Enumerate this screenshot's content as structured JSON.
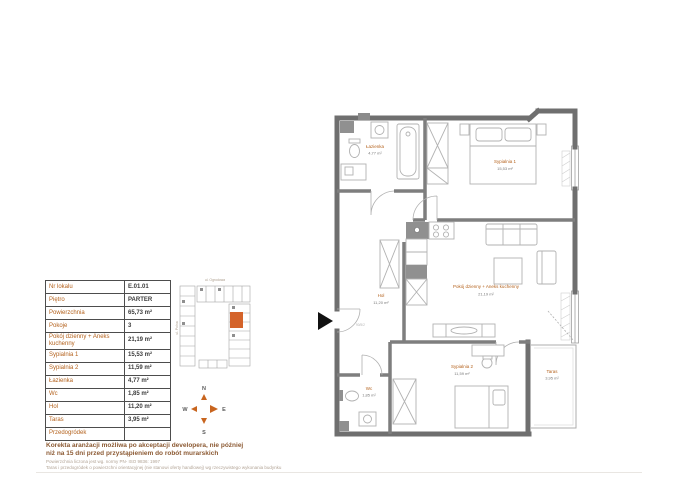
{
  "accent": {
    "label_color": "#b4621d",
    "area_color": "#7a7a7a",
    "highlight": "#d4632a",
    "wall_color": "#6f6f6f"
  },
  "table": {
    "rows": [
      {
        "label": "Nr lokalu",
        "value": "E.01.01"
      },
      {
        "label": "Piętro",
        "value": "PARTER"
      },
      {
        "label": "Powierzchnia",
        "value": "65,73 m²"
      },
      {
        "label": "Pokoje",
        "value": "3"
      },
      {
        "label": "Pokój dzienny + Aneks kuchenny",
        "value": "21,19 m²"
      },
      {
        "label": "Sypialnia 1",
        "value": "15,53 m²"
      },
      {
        "label": "Sypialnia 2",
        "value": "11,59 m²"
      },
      {
        "label": "Łazienka",
        "value": "4,77 m²"
      },
      {
        "label": "Wc",
        "value": "1,85 m²"
      },
      {
        "label": "Hol",
        "value": "11,20 m²"
      },
      {
        "label": "Taras",
        "value": "3,95 m²"
      },
      {
        "label": "Przedogródek",
        "value": ""
      }
    ]
  },
  "locator": {
    "street_top": "ul. Ogrodowa",
    "street_left": "ul. Polna"
  },
  "compass": {
    "north": "N",
    "east": "E",
    "south": "S",
    "west": "W"
  },
  "floorplan": {
    "rooms": {
      "lazienka": {
        "name": "Łazienka",
        "area": "4,77 m²"
      },
      "sypialnia1": {
        "name": "Sypialnia 1",
        "area": "15,53 m²"
      },
      "pokoj": {
        "name": "Pokój dzienny + Aneks kuchenny",
        "area": "21,19 m²"
      },
      "hol": {
        "name": "Hol",
        "area": "11,20 m²"
      },
      "sypialnia2": {
        "name": "Sypialnia 2",
        "area": "11,59 m²"
      },
      "wc": {
        "name": "Wc",
        "area": "1,85 m²"
      },
      "taras": {
        "name": "Taras",
        "area": "3,95 m²"
      }
    },
    "entrance_door_code": "90/5/2"
  },
  "footer": {
    "bold_line1": "Korekta aranżacji możliwa po akceptacji developera, nie później",
    "bold_line2": "niż na 15 dni przed przystąpieniem do robót murarskich",
    "note1": "Powierzchnia liczona jest wg. normy PN- ISO 9836: 1997",
    "note2": "Taras i przedogródek o powierzchni orientacyjnej (nie stanowi oferty handlowej) wg rzeczywistego wykonania budynku"
  }
}
